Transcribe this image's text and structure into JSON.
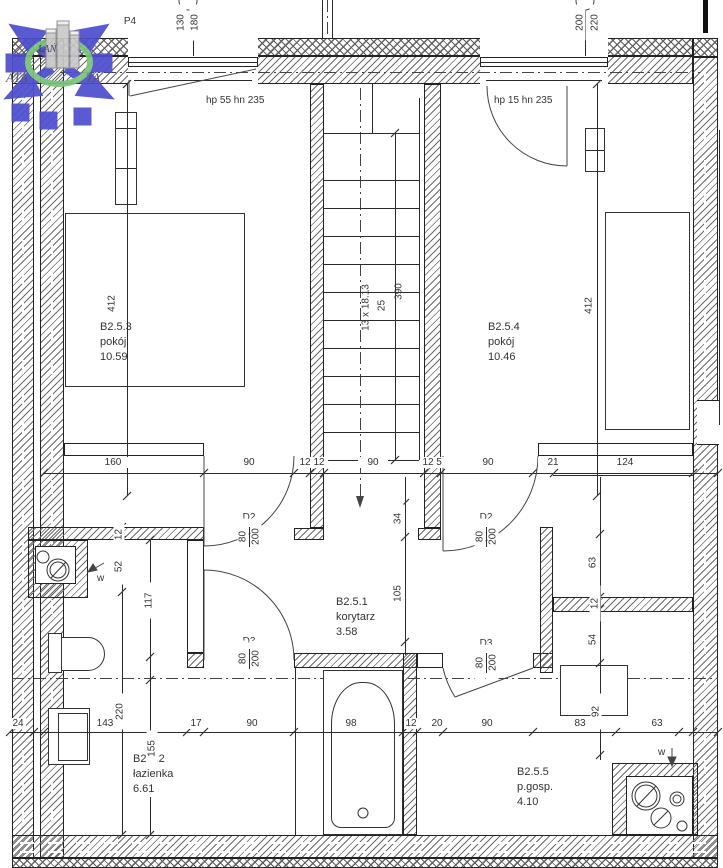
{
  "colors": {
    "line": "#2b2b2b",
    "dim_text": "#333333",
    "logo_blue": "#4d4dd0",
    "logo_green": "#79c479",
    "logo_gray": "#c9c9c9"
  },
  "logo": {
    "left": "ATA",
    "right": "TA",
    "small": "ŁAŃ"
  },
  "header": {
    "p4": "P4"
  },
  "windows": {
    "left_hp": "hp 55 hn 235",
    "right_hp": "hp 15 hn 235",
    "left_dims": [
      "130",
      "180"
    ],
    "right_dims": [
      "200",
      "220"
    ]
  },
  "rooms": {
    "pokoj1": {
      "id": "B2.5.3",
      "name": "pokój",
      "area": "10.59"
    },
    "pokoj2": {
      "id": "B2.5.4",
      "name": "pokój",
      "area": "10.46"
    },
    "korytarz": {
      "id": "B2.5.1",
      "name": "korytarz",
      "area": "3.58"
    },
    "lazienka": {
      "id": "B2.5.2",
      "name": "łazienka",
      "area": "6.61"
    },
    "pgosp": {
      "id": "B2.5.5",
      "name": "p.gosp.",
      "area": "4.10"
    }
  },
  "stairs": {
    "label": "13 x 18.13",
    "tread": "25",
    "length": "390"
  },
  "doors": {
    "d2": {
      "name": "D2",
      "width": "80",
      "height": "200"
    },
    "d3": {
      "name": "D3",
      "width": "80",
      "height": "200"
    }
  },
  "vent": "w",
  "dims": {
    "rowA": [
      "160",
      "90",
      "12",
      "12",
      "90",
      "12",
      "5",
      "90",
      "21",
      "124"
    ],
    "rowB": [
      "24",
      "143",
      "220",
      "17",
      "90",
      "98",
      "12",
      "20",
      "90",
      "83",
      "92",
      "63"
    ],
    "bath": [
      "12",
      "52",
      "117",
      "155"
    ],
    "right": [
      "63",
      "12",
      "54"
    ],
    "mid": [
      "34",
      "105"
    ],
    "roomHeights": [
      "412",
      "412"
    ]
  }
}
